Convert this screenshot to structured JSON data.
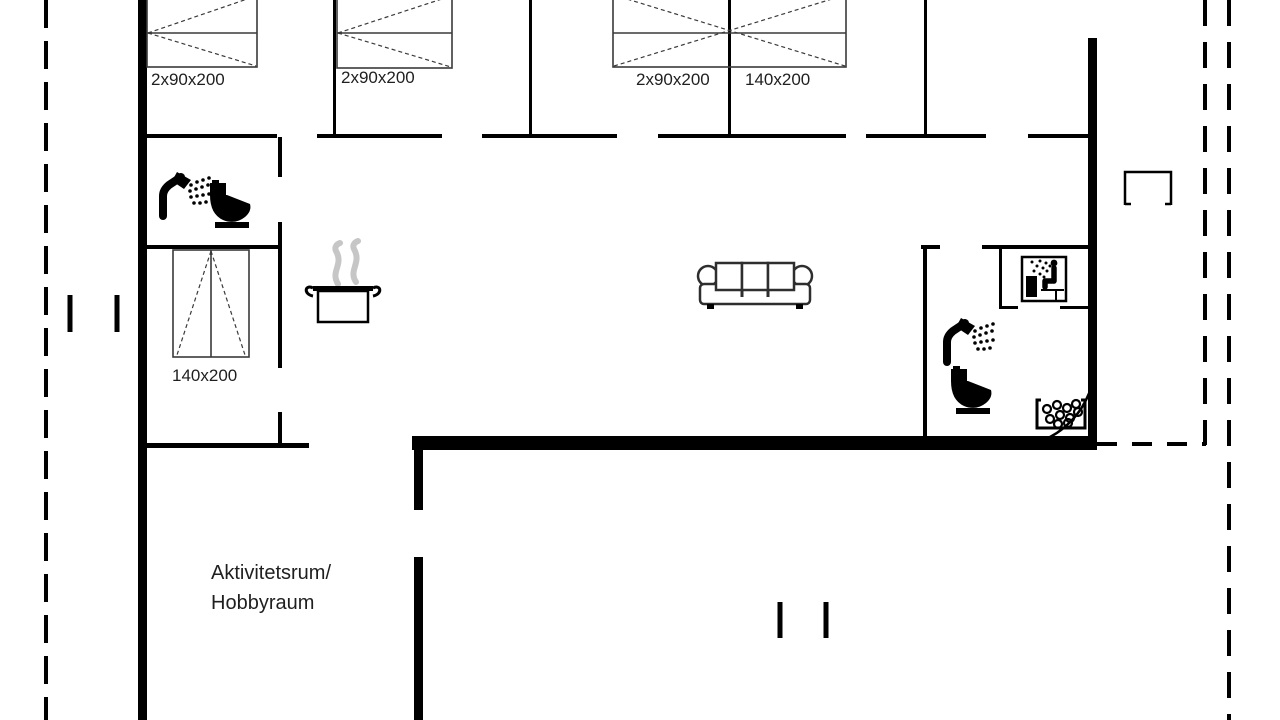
{
  "floor_plan": {
    "beds": [
      {
        "id": "bed-1",
        "label": "2x90x200"
      },
      {
        "id": "bed-2",
        "label": "2x90x200"
      },
      {
        "id": "bed-3",
        "label": "2x90x200"
      },
      {
        "id": "bed-4",
        "label": "140x200"
      },
      {
        "id": "bed-5",
        "label": "140x200"
      }
    ],
    "rooms": {
      "activity_room_line1": "Aktivitetsrum/",
      "activity_room_line2": "Hobbyraum"
    },
    "icons": [
      "shower-icon",
      "toilet-icon",
      "cooking-pot-icon",
      "steam-icon",
      "sofa-icon",
      "sauna-icon",
      "whirlpool-tub-icon",
      "door-swing-arc",
      "entrance-step-marker"
    ],
    "colors": {
      "wall": "#000000",
      "line": "#3a3a3a",
      "steam": "#c6c6c6",
      "text": "#1f1f1f",
      "background": "#ffffff"
    }
  }
}
